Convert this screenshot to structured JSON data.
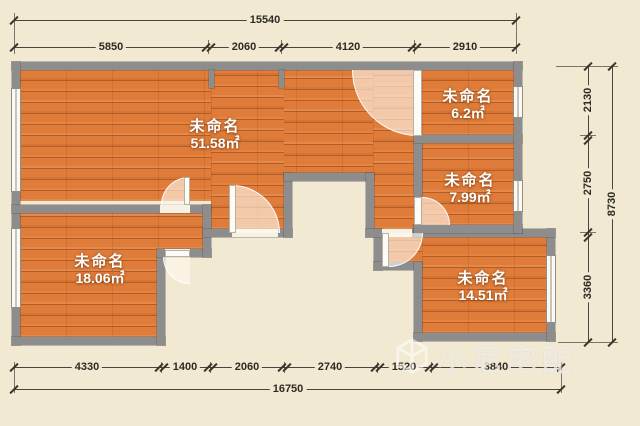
{
  "watermark": {
    "brand": "小尼宅配",
    "logo": "cube-icon"
  },
  "rooms": [
    {
      "name": "未命名",
      "area": "51.58㎡"
    },
    {
      "name": "未命名",
      "area": "6.2㎡"
    },
    {
      "name": "未命名",
      "area": "7.99㎡"
    },
    {
      "name": "未命名",
      "area": "18.06㎡"
    },
    {
      "name": "未命名",
      "area": "14.51㎡"
    }
  ],
  "dimensions": {
    "top": {
      "total": "15540",
      "segments": [
        "5850",
        "2060",
        "4120",
        "2910"
      ]
    },
    "right": {
      "total": "8730",
      "segments": [
        "2130",
        "2750",
        "3360"
      ]
    },
    "bottom": {
      "total": "16750",
      "segments": [
        "4330",
        "1400",
        "2060",
        "2740",
        "1520",
        "3840"
      ]
    }
  },
  "colors": {
    "floor": "#df7c39",
    "wall": "#8d8d8d",
    "background": "#f2e9d3",
    "dimension_text": "#2e2b24",
    "room_text": "#ffffff"
  }
}
